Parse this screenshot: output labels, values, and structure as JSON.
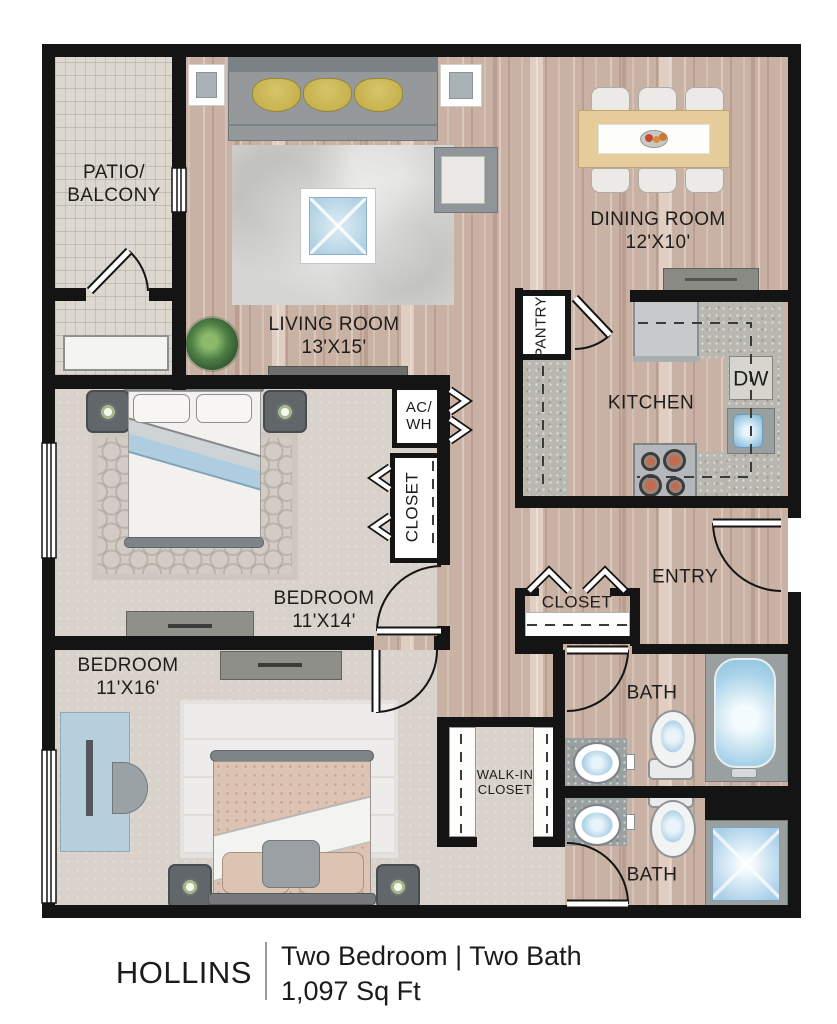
{
  "plan": {
    "labels": {
      "patio": [
        "PATIO/",
        "BALCONY"
      ],
      "living": [
        "LIVING ROOM",
        "13'X15'"
      ],
      "dining": [
        "DINING ROOM",
        "12'X10'"
      ],
      "kitchen": "KITCHEN",
      "pantry": "PANTRY",
      "dishwasher": "DW",
      "ac_wh": [
        "AC/",
        "WH"
      ],
      "bedroom1": [
        "BEDROOM",
        "11'X14'"
      ],
      "bedroom1_closet": "CLOSET",
      "bedroom2": [
        "BEDROOM",
        "11'X16'"
      ],
      "entry": "ENTRY",
      "entry_closet": "CLOSET",
      "bath1": "BATH",
      "bath2": "BATH",
      "walk_in_closet": [
        "WALK-IN",
        "CLOSET"
      ]
    }
  },
  "caption": {
    "plan_name": "HOLLINS",
    "type_line": "Two Bedroom | Two Bath",
    "area_line": "1,097 Sq Ft"
  },
  "colors": {
    "wall": "#141414",
    "wood": "#c9b2a4",
    "carpet": "#d8d2cb",
    "accent_blue": "#a9cde2",
    "pillow_yellow": "#c9b557"
  }
}
